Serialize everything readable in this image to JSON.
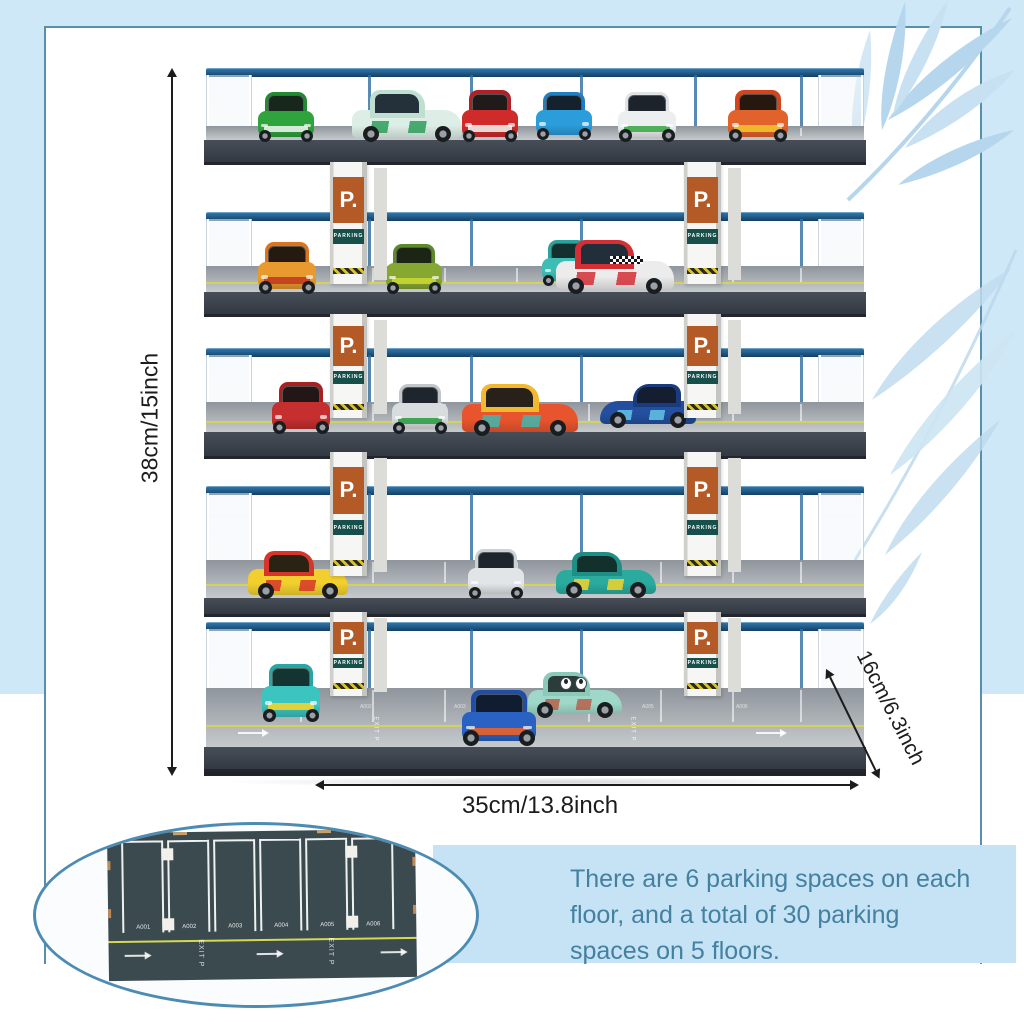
{
  "annotations": {
    "height_label": "38cm/15inch",
    "width_label": "35cm/13.8inch",
    "depth_label": "16cm/6.3inch"
  },
  "description": {
    "lines": [
      "There are 6 parking spaces on each",
      "floor, and a total of 30 parking",
      "spaces on 5 floors."
    ]
  },
  "pillar_sign": {
    "p_label": "P.",
    "parking_label": "PARKING"
  },
  "colors": {
    "background_blue": "#cfe8f8",
    "panel_border": "#5890ac",
    "accent_text": "#44809f",
    "sign_orange": "#b45a26",
    "sign_teal": "#17504a",
    "rail_blue": "#1d5c8e",
    "deck_dark": "#3d444d",
    "mat_green": "#3a4a4f",
    "lane_yellow": "#d6d650",
    "oval_border": "#4d8cb2",
    "inset_panel_blue": "#c6e3f6"
  },
  "garage": {
    "floor_count": 5,
    "spaces_per_floor": 6,
    "posts_x": [
      368,
      470,
      580,
      694,
      800
    ],
    "pillar_rows": [
      {
        "top": 162,
        "bottom": 284
      },
      {
        "top": 314,
        "bottom": 418
      },
      {
        "top": 452,
        "bottom": 576
      },
      {
        "top": 612,
        "bottom": 696
      }
    ],
    "floors": [
      {
        "rail_y": 68,
        "surf_y": 126,
        "surf_h": 14,
        "fas_h": 22,
        "yellow": false,
        "base": false,
        "cars": [
          {
            "style": "front",
            "x": 258,
            "bottom": 140,
            "w": 56,
            "h": 48,
            "body": "#2fa33c",
            "roof": "#228a30",
            "win": "#18271c",
            "accent": "#e8f2e8"
          },
          {
            "style": "side",
            "x": 352,
            "bottom": 140,
            "w": 110,
            "h": 50,
            "dir": "right",
            "body": "#ddeee6",
            "roof": "#bfe0d0",
            "win": "#24303a",
            "accent": "#2e9e5b"
          },
          {
            "style": "front",
            "x": 462,
            "bottom": 140,
            "w": 56,
            "h": 50,
            "body": "#cf2b2b",
            "roof": "#b11f27",
            "win": "#201a1a",
            "accent": "#efe9e6"
          },
          {
            "style": "front",
            "x": 536,
            "bottom": 138,
            "w": 56,
            "h": 46,
            "body": "#2b9ddb",
            "roof": "#1f7fc0",
            "win": "#15222e"
          },
          {
            "style": "front",
            "x": 618,
            "bottom": 140,
            "w": 58,
            "h": 48,
            "body": "#eceff0",
            "roof": "#dfe3e5",
            "win": "#1c232b",
            "accent": "#3faa4a"
          },
          {
            "style": "front",
            "x": 728,
            "bottom": 140,
            "w": 60,
            "h": 50,
            "body": "#e2622b",
            "roof": "#d4451f",
            "win": "#26180f",
            "accent": "#f2c12e"
          }
        ]
      },
      {
        "rail_y": 212,
        "surf_y": 266,
        "surf_h": 26,
        "fas_h": 22,
        "yellow": true,
        "base": false,
        "cars": [
          {
            "style": "front",
            "x": 258,
            "bottom": 292,
            "w": 58,
            "h": 50,
            "body": "#e89a2e",
            "roof": "#d9741f",
            "win": "#241a10",
            "accent": "#c43b20"
          },
          {
            "style": "front",
            "x": 386,
            "bottom": 292,
            "w": 56,
            "h": 48,
            "body": "#86a832",
            "roof": "#5d8a28",
            "win": "#1c2414",
            "accent": "#c8d832"
          },
          {
            "style": "front",
            "x": 542,
            "bottom": 284,
            "w": 50,
            "h": 44,
            "body": "#3dbdb5",
            "roof": "#2aa39c",
            "win": "#14302e"
          },
          {
            "style": "side",
            "x": 556,
            "bottom": 292,
            "w": 118,
            "h": 52,
            "dir": "right",
            "body": "#ececec",
            "roof": "#d42f35",
            "win": "#222e3a",
            "accent": "#d42f35",
            "checker": true
          }
        ]
      },
      {
        "rail_y": 348,
        "surf_y": 402,
        "surf_h": 30,
        "fas_h": 24,
        "yellow": true,
        "base": false,
        "cars": [
          {
            "style": "front",
            "x": 272,
            "bottom": 432,
            "w": 58,
            "h": 50,
            "body": "#c62f2f",
            "roof": "#a82020",
            "win": "#231616"
          },
          {
            "style": "front",
            "x": 392,
            "bottom": 432,
            "w": 56,
            "h": 48,
            "body": "#d9dcdf",
            "roof": "#c3c7cb",
            "win": "#1e252c",
            "accent": "#2f9e46"
          },
          {
            "style": "side",
            "x": 462,
            "bottom": 434,
            "w": 116,
            "h": 50,
            "dir": "right",
            "body": "#e8542e",
            "roof": "#f2b82e",
            "win": "#27211a",
            "accent": "#3fb8ae"
          },
          {
            "style": "side",
            "x": 600,
            "bottom": 426,
            "w": 96,
            "h": 42,
            "dir": "left",
            "body": "#234f9e",
            "roof": "#1a3c7e",
            "win": "#141e30",
            "accent": "#62c4e8"
          }
        ]
      },
      {
        "rail_y": 486,
        "surf_y": 560,
        "surf_h": 38,
        "fas_h": 16,
        "yellow": true,
        "base": false,
        "cars": [
          {
            "style": "side",
            "x": 248,
            "bottom": 597,
            "w": 100,
            "h": 46,
            "dir": "right",
            "body": "#f2cf2e",
            "roof": "#d8352a",
            "win": "#2a2212",
            "accent": "#d8352a"
          },
          {
            "style": "front",
            "x": 468,
            "bottom": 597,
            "w": 56,
            "h": 48,
            "body": "#e2e5e8",
            "roof": "#ccd1d5",
            "win": "#1e252c"
          },
          {
            "style": "side",
            "x": 556,
            "bottom": 596,
            "w": 100,
            "h": 44,
            "dir": "right",
            "body": "#2aab9e",
            "roof": "#1f8f86",
            "win": "#12302c",
            "accent": "#f2d42e"
          }
        ]
      },
      {
        "rail_y": 622,
        "surf_y": 688,
        "surf_h": 59,
        "fas_h": 22,
        "yellow": true,
        "base": true,
        "cars": [
          {
            "style": "front",
            "x": 262,
            "bottom": 720,
            "w": 58,
            "h": 56,
            "body": "#3cc4c0",
            "roof": "#2aa5a5",
            "win": "#143432",
            "accent": "#f2d42e"
          },
          {
            "style": "side",
            "x": 528,
            "bottom": 716,
            "w": 94,
            "h": 44,
            "dir": "right",
            "body": "#9fd8c8",
            "roof": "#8ccab8",
            "win": "#2c3c3a",
            "accent": "#b8604a",
            "face": true
          },
          {
            "style": "front",
            "x": 462,
            "bottom": 744,
            "w": 74,
            "h": 54,
            "body": "#2a62c4",
            "roof": "#1f4da8",
            "win": "#101c30",
            "accent": "#e8632a"
          }
        ]
      }
    ]
  },
  "inset": {
    "space_labels": [
      "A001",
      "A002",
      "A003",
      "A004",
      "A005",
      "A006"
    ],
    "exit_label": "EXIT",
    "p_label": "P"
  }
}
